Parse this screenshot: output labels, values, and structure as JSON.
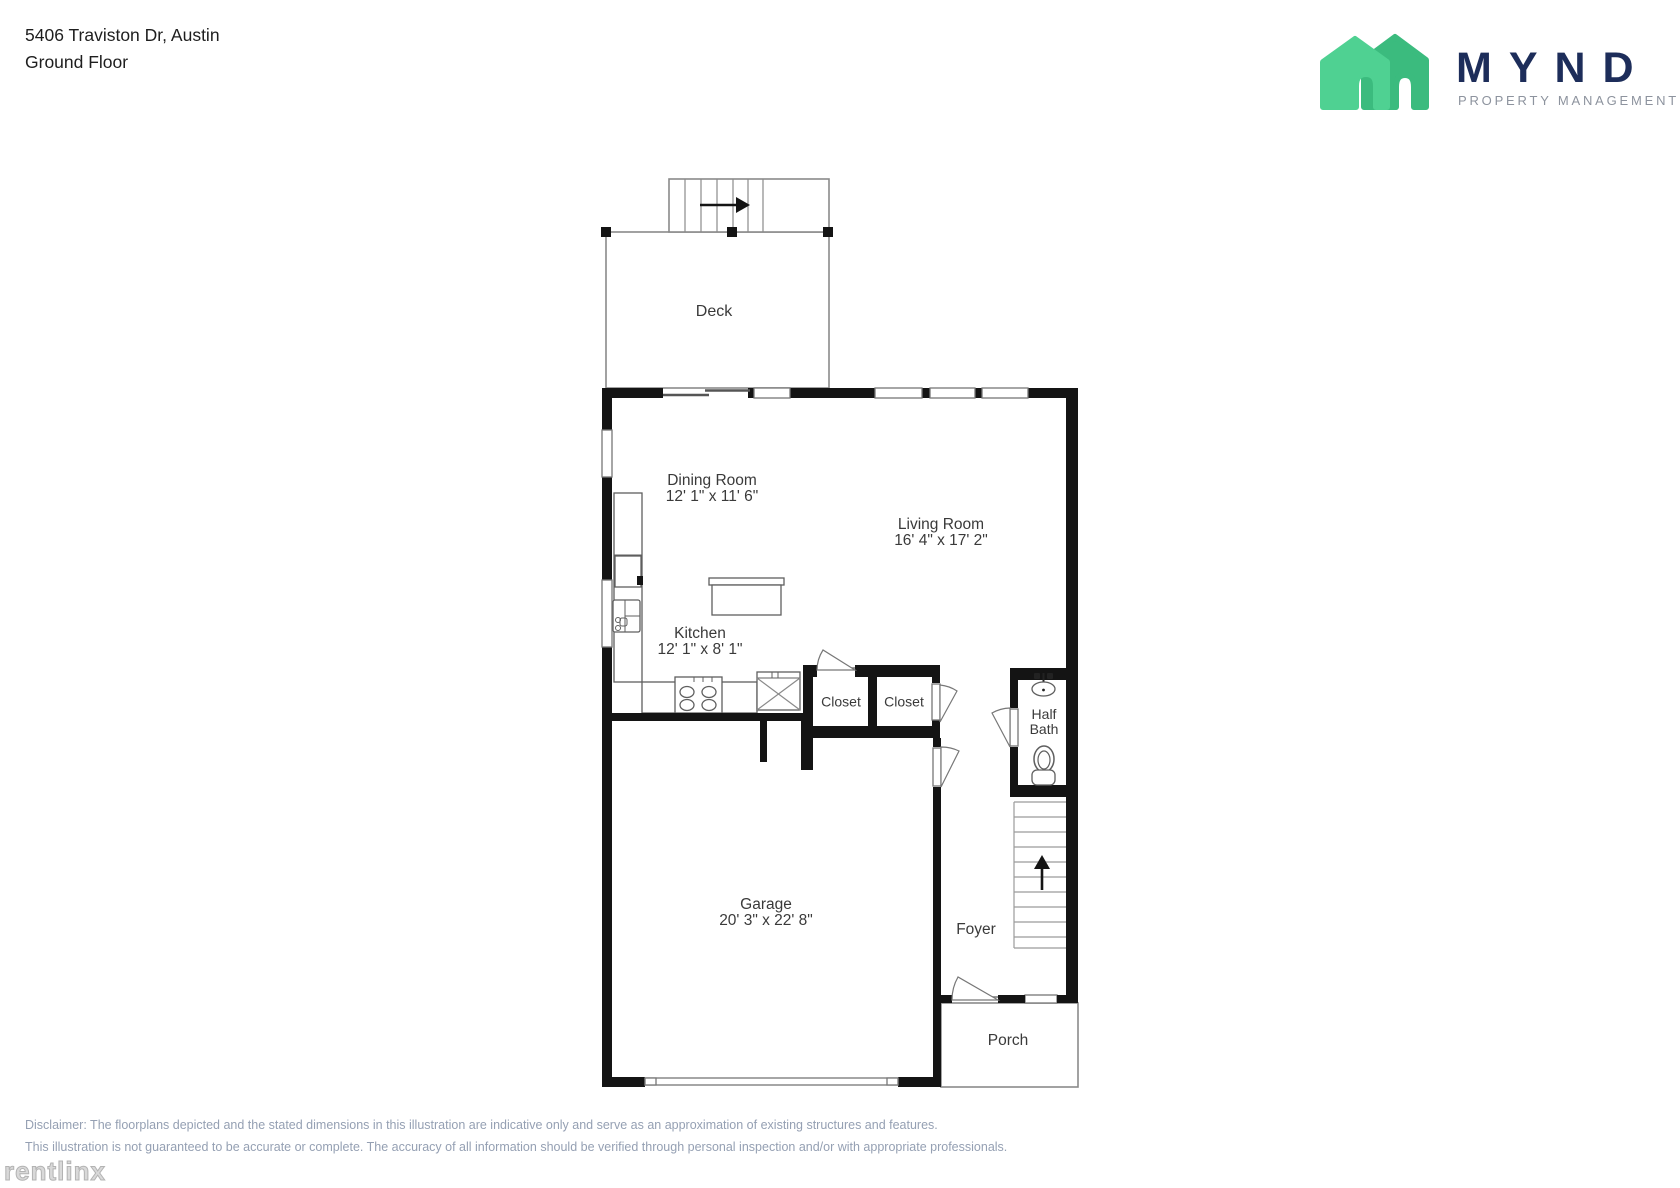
{
  "header": {
    "address": "5406 Traviston Dr, Austin",
    "floor": "Ground Floor"
  },
  "logo": {
    "name": "MYND",
    "tagline": "PROPERTY MANAGEMENT",
    "brand_navy": "#1d2d5a",
    "brand_green_light": "#4fd192",
    "brand_green_dark": "#3bbb7e",
    "tagline_gray": "#8d939e"
  },
  "rooms": {
    "deck": {
      "label": "Deck"
    },
    "dining": {
      "label": "Dining Room",
      "dims": "12' 1\" x 11' 6\""
    },
    "living": {
      "label": "Living Room",
      "dims": "16' 4\" x 17' 2\""
    },
    "kitchen": {
      "label": "Kitchen",
      "dims": "12' 1\" x 8' 1\""
    },
    "closet1": {
      "label": "Closet"
    },
    "closet2": {
      "label": "Closet"
    },
    "half_bath": {
      "label_line1": "Half",
      "label_line2": "Bath"
    },
    "garage": {
      "label": "Garage",
      "dims": "20' 3\" x 22' 8\""
    },
    "foyer": {
      "label": "Foyer"
    },
    "porch": {
      "label": "Porch"
    }
  },
  "footer": {
    "disclaimer_line1": "Disclaimer: The floorplans depicted and the stated dimensions in this illustration are indicative only and serve as an approximation of existing structures and features.",
    "disclaimer_line2": "This illustration is not guaranteed to be accurate or complete. The accuracy of all information should be verified through personal inspection and/or with appropriate professionals.",
    "watermark": "rentlinx"
  }
}
